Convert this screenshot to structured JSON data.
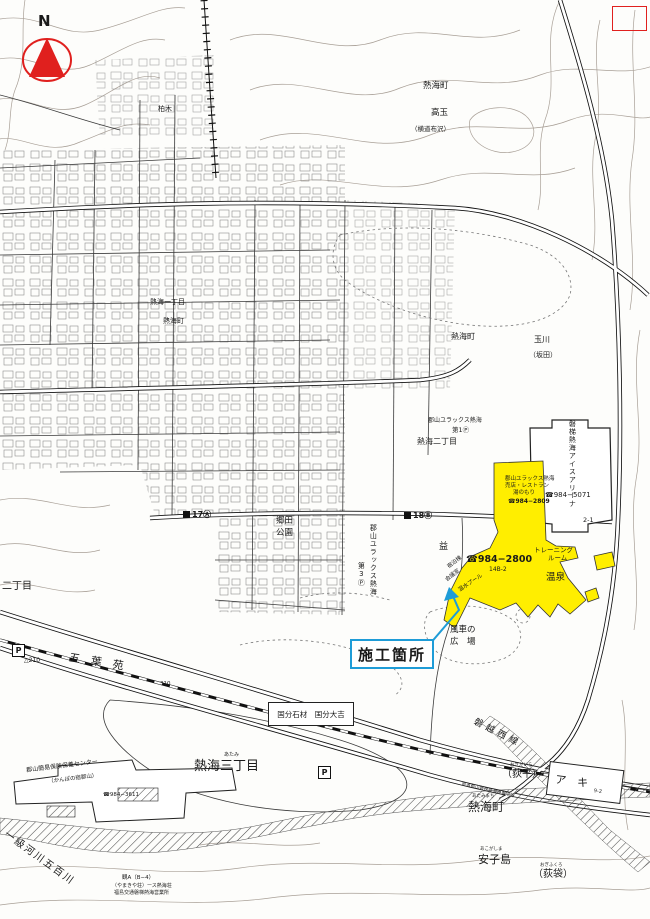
{
  "compass": {
    "n": "N"
  },
  "annotation": {
    "label": "施工箇所"
  },
  "labels": {
    "kashiwagi": "柏木",
    "atami_cho_top": "熱海町",
    "takatama": "高玉",
    "takatama_sub": "（横道布沢）",
    "atami_1chome": "熱海一丁目",
    "atami_cho_mid": "熱海町",
    "atami_cho_center": "熱海町",
    "tamagawa": "玉川",
    "sakata": "（坂田）",
    "atami_2chome": "熱海二丁目",
    "p1_1": "郡山ユラックス熱海",
    "p1_2": "第1Ⓟ",
    "arena_vert": "磐梯熱海アイスアリーナ",
    "arena_phone": "☎984−5071",
    "lot21": "2-1",
    "fac1": "郡山ユラックス熱海",
    "fac2": "売店・レストラン",
    "fac3": "湯のもり",
    "fac_phone": "☎984−2809",
    "main_phone": "☎984−2800",
    "main_lot": "14B-2",
    "tr1": "トレーニング",
    "tr2": "ルーム",
    "onsen": "温泉",
    "wing1": "宿泊棟",
    "wing2": "会議室",
    "wing3": "温水プール",
    "p3_1": "郡山ユラックス熱海",
    "p3_2": "第3Ⓟ",
    "goda1": "郷田",
    "goda2": "公園",
    "m17": "17Ⓐ",
    "m18": "18Ⓑ",
    "masu": "益",
    "fusha1": "風車の",
    "fusha2": "広　場",
    "gobyoen": "五　葉　苑",
    "nichome": "二丁目",
    "kokubu": "国分石材　国分大吉",
    "atami3_f": "あたみ",
    "atami3": "熱海三丁目",
    "banetsu": "磐越西線",
    "ogid_f": "おぎだいら",
    "ogidaira": "（荻平）",
    "aki": "ア　キ",
    "aki_lot": "9-2",
    "prefroad": "県道郡山磐梯熱海停車場線",
    "atamib_f": "あたみまち",
    "atamib": "熱海町",
    "ako_f": "あこがしま",
    "ako": "安子島",
    "ogif_f": "おぎふくろ",
    "ogifukuro": "（荻袋）",
    "ikkyu": "一級河川五百川",
    "kampo1": "郡山簡易保険保養センター",
    "kampo2": "（かんぽの宿郡山）",
    "kampo3": "☎984−3611",
    "note1": "観A（B−4）",
    "note2": "（やまきや荘）ース熱海荘",
    "note3": "福島交通磐梯熱海営業所",
    "bench210": "△210",
    "bench310": "310",
    "p": "P"
  },
  "colors": {
    "highlight": "#ffee00",
    "callout_blue": "#1e9cd7",
    "compass_red": "#e0201e"
  }
}
